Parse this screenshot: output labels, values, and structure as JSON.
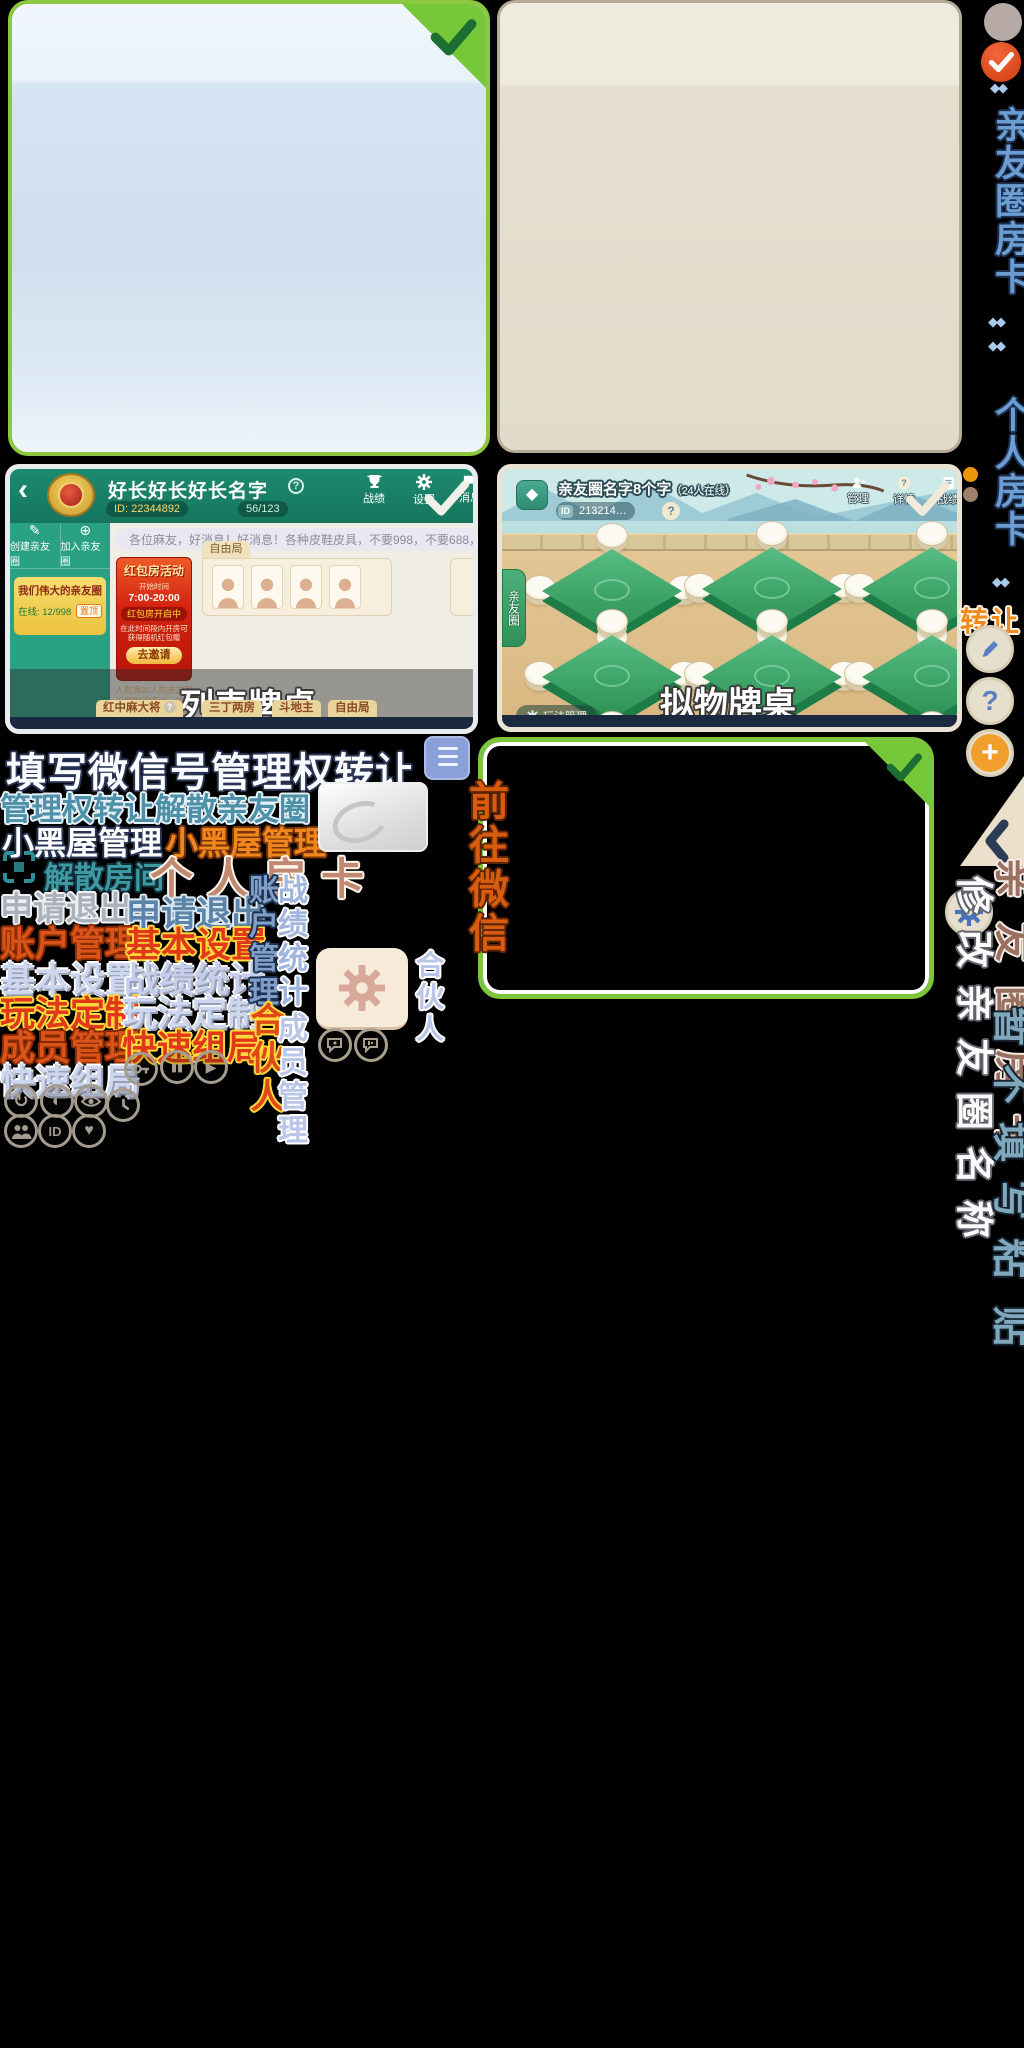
{
  "colors": {
    "selected_green": "#7cc63c",
    "check_dark_green": "#1d6e33",
    "card_blue_fill": "#dce9f6",
    "card_beige_fill": "#ebe5d6",
    "teal_header": "#1b8169",
    "sidebar_teal": "#2ba183",
    "accent_orange": "#f08a1e",
    "rail_blue": "#6b9cd2",
    "rail_brown": "#9a7060",
    "rail_teal": "#7fa8bd"
  },
  "glyphs": {
    "check": "✓",
    "back": "‹",
    "question": "?",
    "plus": "+",
    "diamond": "◆",
    "pair": "◆◆",
    "pause": "▮▮",
    "play": "▶",
    "redo": "↻",
    "yin": "◐",
    "heart": "♥",
    "id_text": "ID",
    "chevron": "‹",
    "create_icon": "✎",
    "join_icon": "⊕"
  },
  "list_shot": {
    "caption": "列表牌桌",
    "title": "好长好长好长名字",
    "id_pill": "ID: 22344892",
    "members": "56/123",
    "action_stats": "战绩",
    "action_settings": "设置",
    "action_messages": "消息",
    "btn_create": "创建亲友圈",
    "btn_join": "加入亲友圈",
    "gold_title": "我们伟大的亲友圈",
    "gold_online": "在线: 12/998",
    "gold_pin": "置顶",
    "announcement": "各位麻友，好消息！好消息！各种皮鞋皮具，不要998，不要688，只要98元，只…",
    "promo": {
      "title": "红包房活动",
      "time_label": "开始时间",
      "time": "7:00-20:00",
      "status": "红包房开启中",
      "desc": "在此时间段内开房可获得随机红包赠",
      "button": "去邀请",
      "note": "人数满20人的亲友圈可参加该活动，该圈只有13人不符合参与条件"
    },
    "freeplay_tab": "自由局",
    "tabs": [
      "红中麻大将",
      "三丁两房",
      "斗地主",
      "自由局"
    ]
  },
  "skeuo_shot": {
    "caption": "拟物牌桌",
    "title": "亲友圈名字8个字",
    "title_suffix": "（24人在线）",
    "id_chip": "ID",
    "id_value": "213214…",
    "action_manage": "管理",
    "action_detail": "详情",
    "action_stats": "战绩",
    "side_tab": "亲友圈",
    "bottom_button": "玩法管理"
  },
  "labels": {
    "fill_wechat_transfer": "填写微信号管理权转让",
    "transfer_dissolve": "管理权转让解散亲友圈",
    "blackroom_white": "小黑屋管理",
    "blackroom_orange": "小黑屋管理",
    "dissolve_room": "解散房间",
    "personal_room_card": "个人房卡",
    "apply_exit_silver": "申请退出",
    "apply_exit_blue": "申请退出",
    "account_mgmt": "账户管理",
    "basic_settings_hl": "基本设置",
    "basic_settings": "基本设置",
    "stats": "战绩统计",
    "rules_hl": "玩法定制",
    "rules": "玩法定制",
    "member_mgmt": "成员管理",
    "quick_group_hl": "快速组局",
    "quick_group": "快速组局",
    "v_account_mgmt": "账户管理",
    "v_partner_orange": "合伙人",
    "v_stats": "战绩统计",
    "v_member_mgmt": "成员管理",
    "v_partner_blue": "合伙人",
    "v_goto_wechat": "前往微信"
  },
  "rail": {
    "circle_room_card": "亲友圈房卡",
    "personal_room_card": "个人房卡",
    "transfer": "转让",
    "brown_room_card": "亲友圈房卡",
    "rename_circle": "修改亲友圈名称",
    "no_fill_paste": "暂不填写粘",
    "paste_tail": "贴"
  }
}
